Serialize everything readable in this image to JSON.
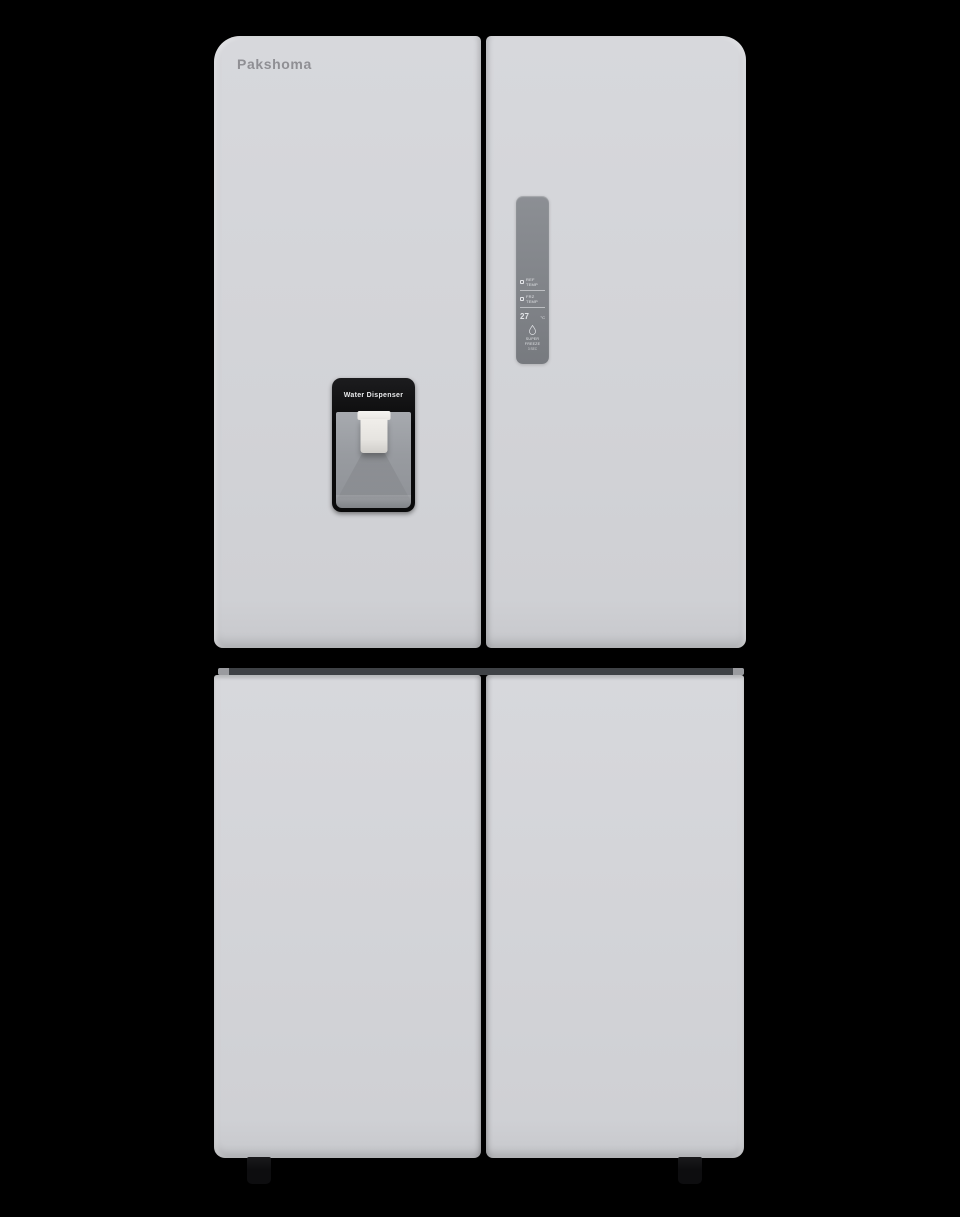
{
  "product": {
    "type": "four-door refrigerator product photo",
    "brand_logo": "Pakshoma"
  },
  "dispenser": {
    "label": "Water Dispenser",
    "paddle_icon": "dispenser-paddle"
  },
  "control_panel": {
    "rows": [
      {
        "icon": "fridge-icon",
        "label": "REF TEMP"
      },
      {
        "icon": "freezer-icon",
        "label": "FRZ TEMP"
      }
    ],
    "temperature": {
      "value": "27",
      "unit": "°C"
    },
    "function": {
      "icon": "water-drop-icon",
      "label": "SUPER FREEZE",
      "sublabel": "3 SEC"
    }
  },
  "colors": {
    "bg": "#000000",
    "door": "#d3d4d8",
    "door-edge": "#c7c8cc",
    "strip": "#3f4246",
    "panel": "#7f8287",
    "panel-text": "#e2e4e7",
    "disp": "#0a0a0b",
    "recess": "#989ba0",
    "paddle": "#edebe7",
    "logo": "#8f8f94",
    "foot": "#0d0d0f"
  }
}
